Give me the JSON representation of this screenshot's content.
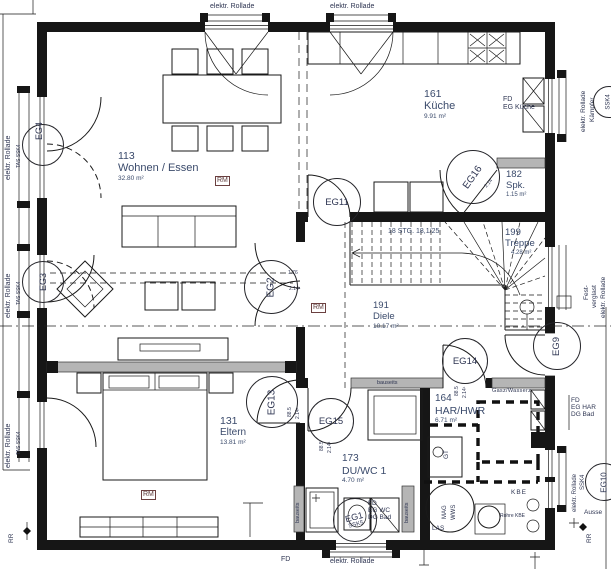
{
  "drawing": {
    "rooms": {
      "wohnen": {
        "number": "113",
        "name": "Wohnen / Essen",
        "area": "32.80 m²"
      },
      "kueche": {
        "number": "161",
        "name": "Küche",
        "area": "9.91 m²"
      },
      "spk": {
        "number": "182",
        "name": "Spk.",
        "area": "1.15 m²"
      },
      "treppe": {
        "number": "199",
        "name": "Treppe",
        "area": "4.28 m²"
      },
      "diele": {
        "number": "191",
        "name": "Diele",
        "area": "10.17 m²"
      },
      "eltern": {
        "number": "131",
        "name": "Eltern",
        "area": "13.81 m²"
      },
      "duwc": {
        "number": "173",
        "name": "DU/WC 1",
        "area": "4.70 m²"
      },
      "har": {
        "number": "164",
        "name": "HAR/HWR",
        "area": "6.71 m²"
      }
    },
    "stairs_note": "18 STG. 18,1/25",
    "doors": {
      "eg1": "EG1",
      "eg1_sub": "SSK5",
      "eg2": "EG2",
      "eg3": "EG3",
      "eg4": "EG4",
      "eg9": "EG9",
      "eg10": "EG10",
      "eg11": "EG11",
      "eg13": "EG13",
      "eg14": "EG14",
      "eg15": "EG15",
      "eg16": "EG16",
      "ssk4_circle": "SSK4"
    },
    "dims": {
      "eg2_width": "1.76",
      "eg2_height": "2.14¹",
      "door_width": "88.5",
      "door_height": "2.14¹",
      "eg16_height": "2.14"
    },
    "labels": {
      "rollade": "elektr. Rollade",
      "kaempfer": "Kämpfer",
      "fest": "Fest-",
      "verglast": "verglast",
      "tas_ssk4": "TAS SSK4",
      "ssk4": "SSK4",
      "rr": "RR",
      "fd": "FD",
      "eg_kueche": "EG Küche",
      "eg_wc": "EG WC",
      "eg_har": "EG HAR",
      "dg_bad": "DG Bad",
      "gasz": "Gasz/Wasserz",
      "kbe": "KBE",
      "rohre_kbe": "Rohre KBE",
      "las": "LAS",
      "mag": "MAG",
      "wws": "WWS",
      "gt": "GT",
      "bauseits": "bauseits",
      "rm": "RM",
      "ausse": "Ausse"
    },
    "colors": {
      "wall": "#161616",
      "gray_wall": "#b5b5b5",
      "room_text": "#3a4a6b",
      "annotation_text": "#2e3552",
      "rm_text": "#5d3a3a"
    }
  }
}
